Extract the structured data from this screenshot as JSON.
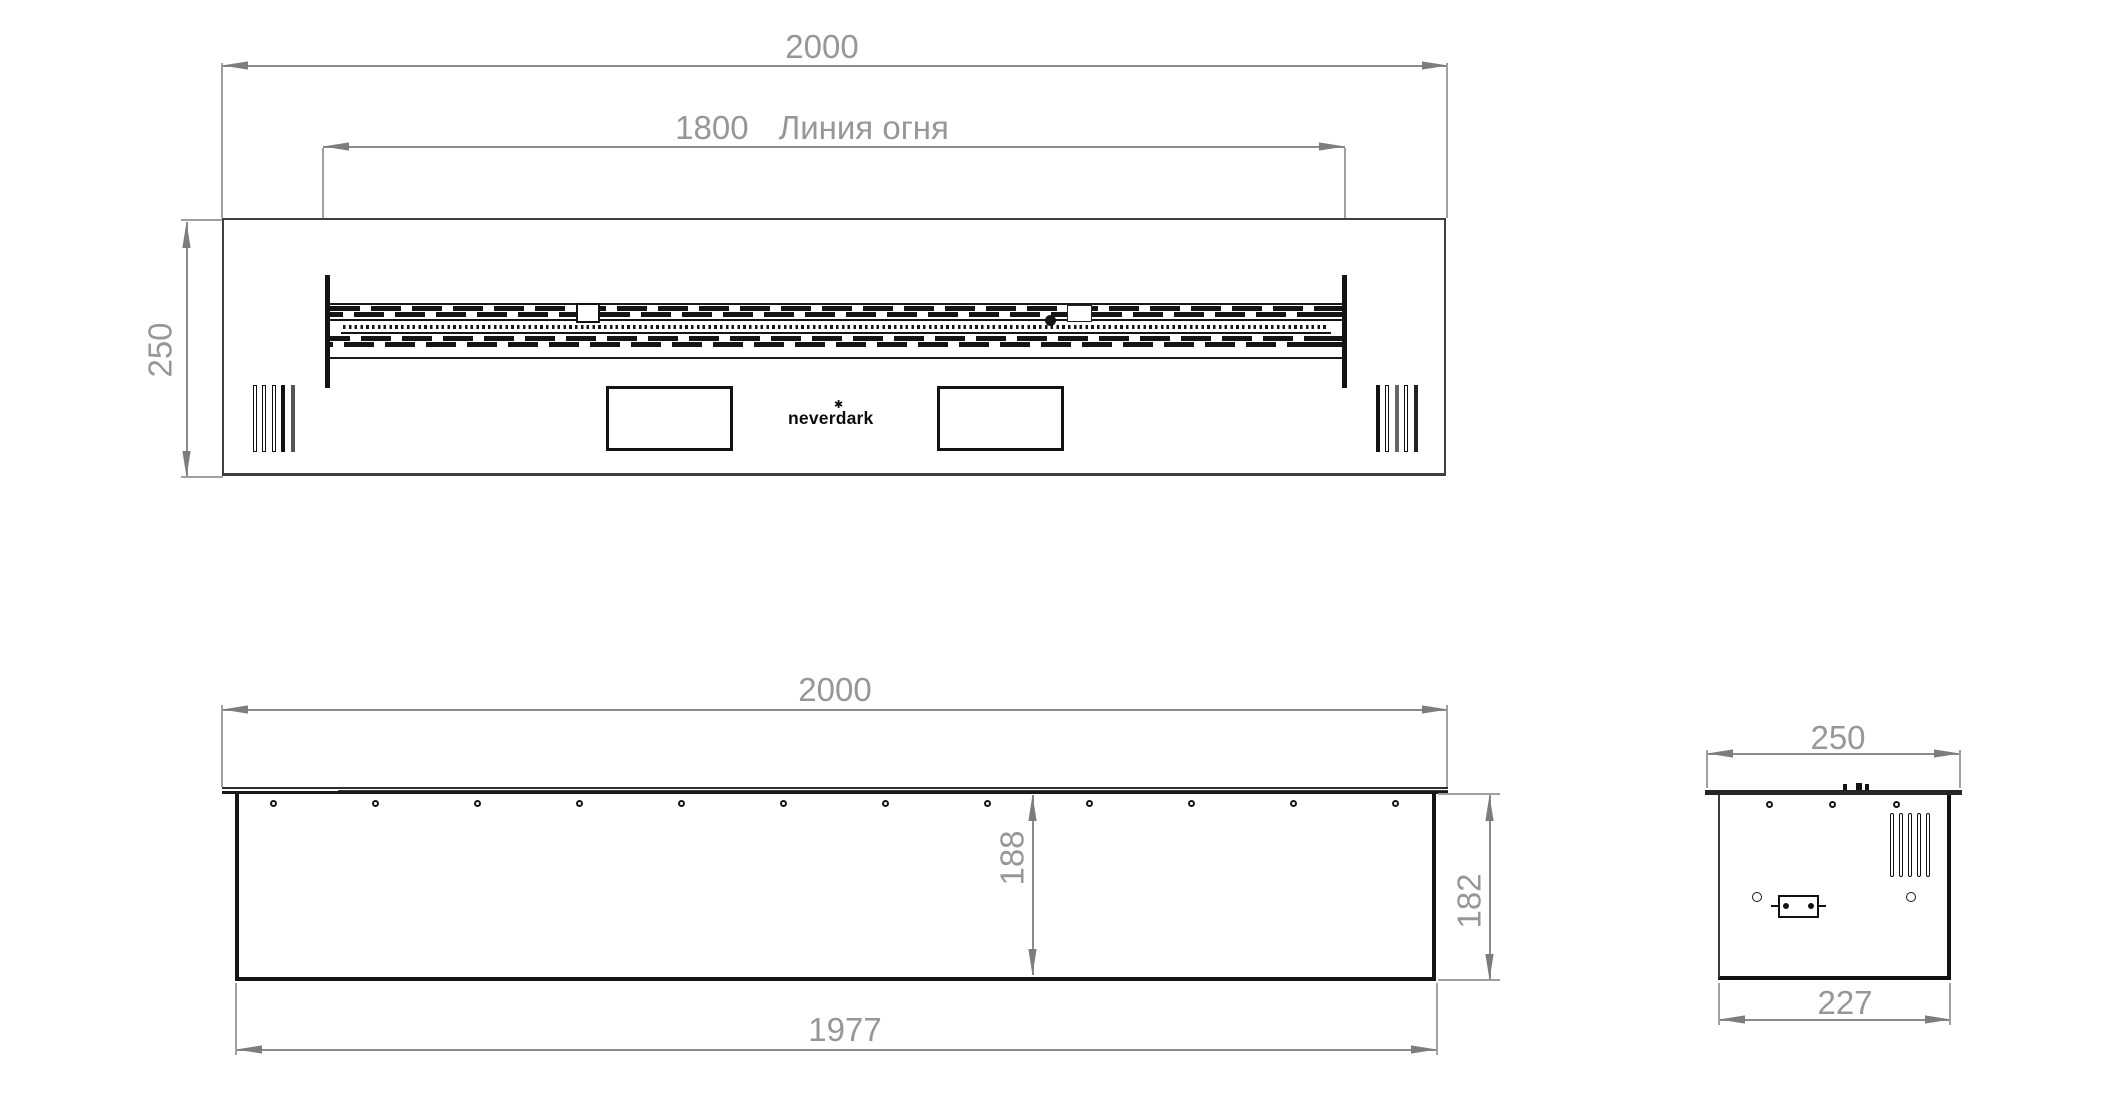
{
  "logo": {
    "text": "neverdark",
    "mark": "✱"
  },
  "top_view": {
    "width_dim": "2000",
    "fire_line_value": "1800",
    "fire_line_label": "Линия огня",
    "depth_dim": "250"
  },
  "front_view": {
    "width_dim": "2000",
    "inner_height_dim": "188",
    "height_dim": "182",
    "bottom_width_dim": "1977"
  },
  "side_view": {
    "top_depth_dim": "250",
    "bottom_depth_dim": "227"
  }
}
